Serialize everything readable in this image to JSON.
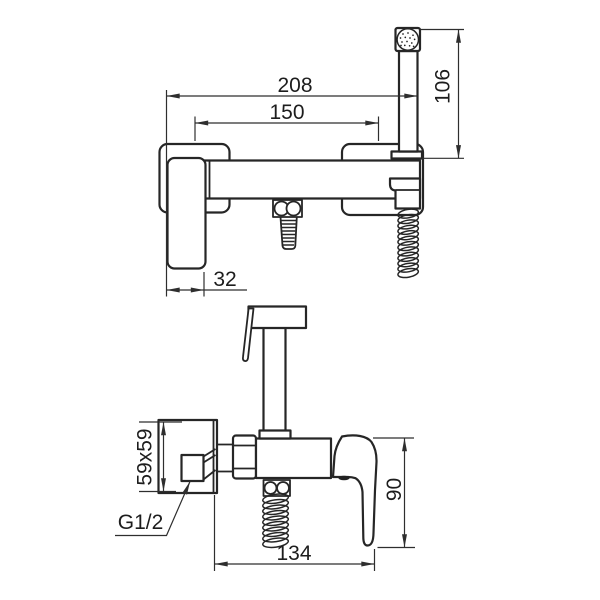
{
  "colors": {
    "line": "#262626",
    "dimension_line": "#2e2e2e",
    "background": "#ffffff"
  },
  "views": {
    "front": {
      "dimensions": {
        "overall_width": "208",
        "mounting_centers": "150",
        "handshower_height": "106",
        "handle_width": "32"
      }
    },
    "side": {
      "dimensions": {
        "wall_plate": "59x59",
        "connection_thread": "G1/2",
        "handle_height": "90",
        "overall_depth": "134"
      }
    }
  }
}
